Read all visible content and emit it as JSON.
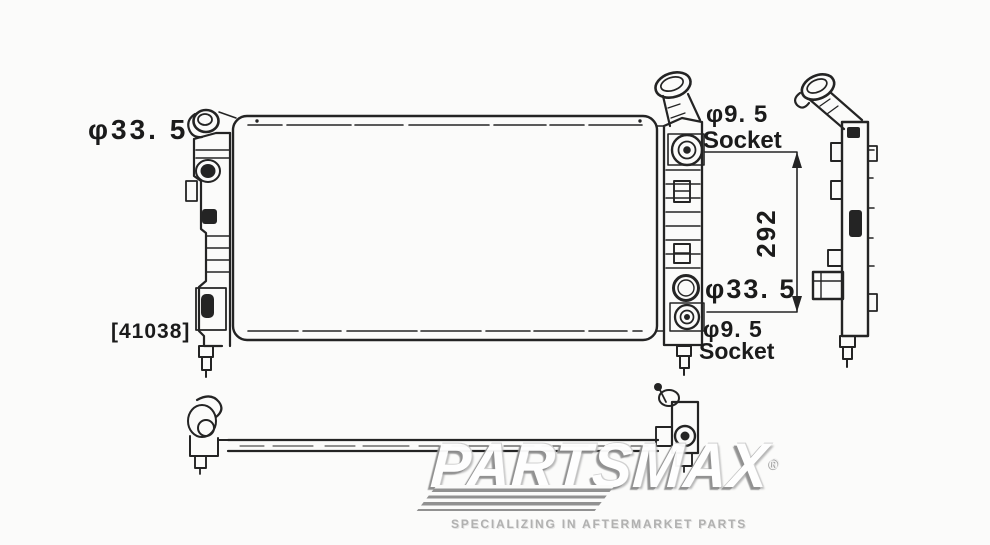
{
  "page": {
    "background": "#fbfbfa",
    "ink": "#242424"
  },
  "diagram": {
    "part_code": "[41038]",
    "labels": {
      "inlet_diameter": "φ33. 5",
      "outlet_diameter": "φ33. 5",
      "tank_span": "292",
      "upper_socket_size": "φ9. 5",
      "upper_socket_text": "Socket",
      "lower_socket_size": "φ9. 5",
      "lower_socket_text": "Socket"
    }
  },
  "watermark": {
    "brand": "PARTSMAX",
    "registered": "®",
    "tagline": "SPECIALIZING IN AFTERMARKET PARTS"
  }
}
